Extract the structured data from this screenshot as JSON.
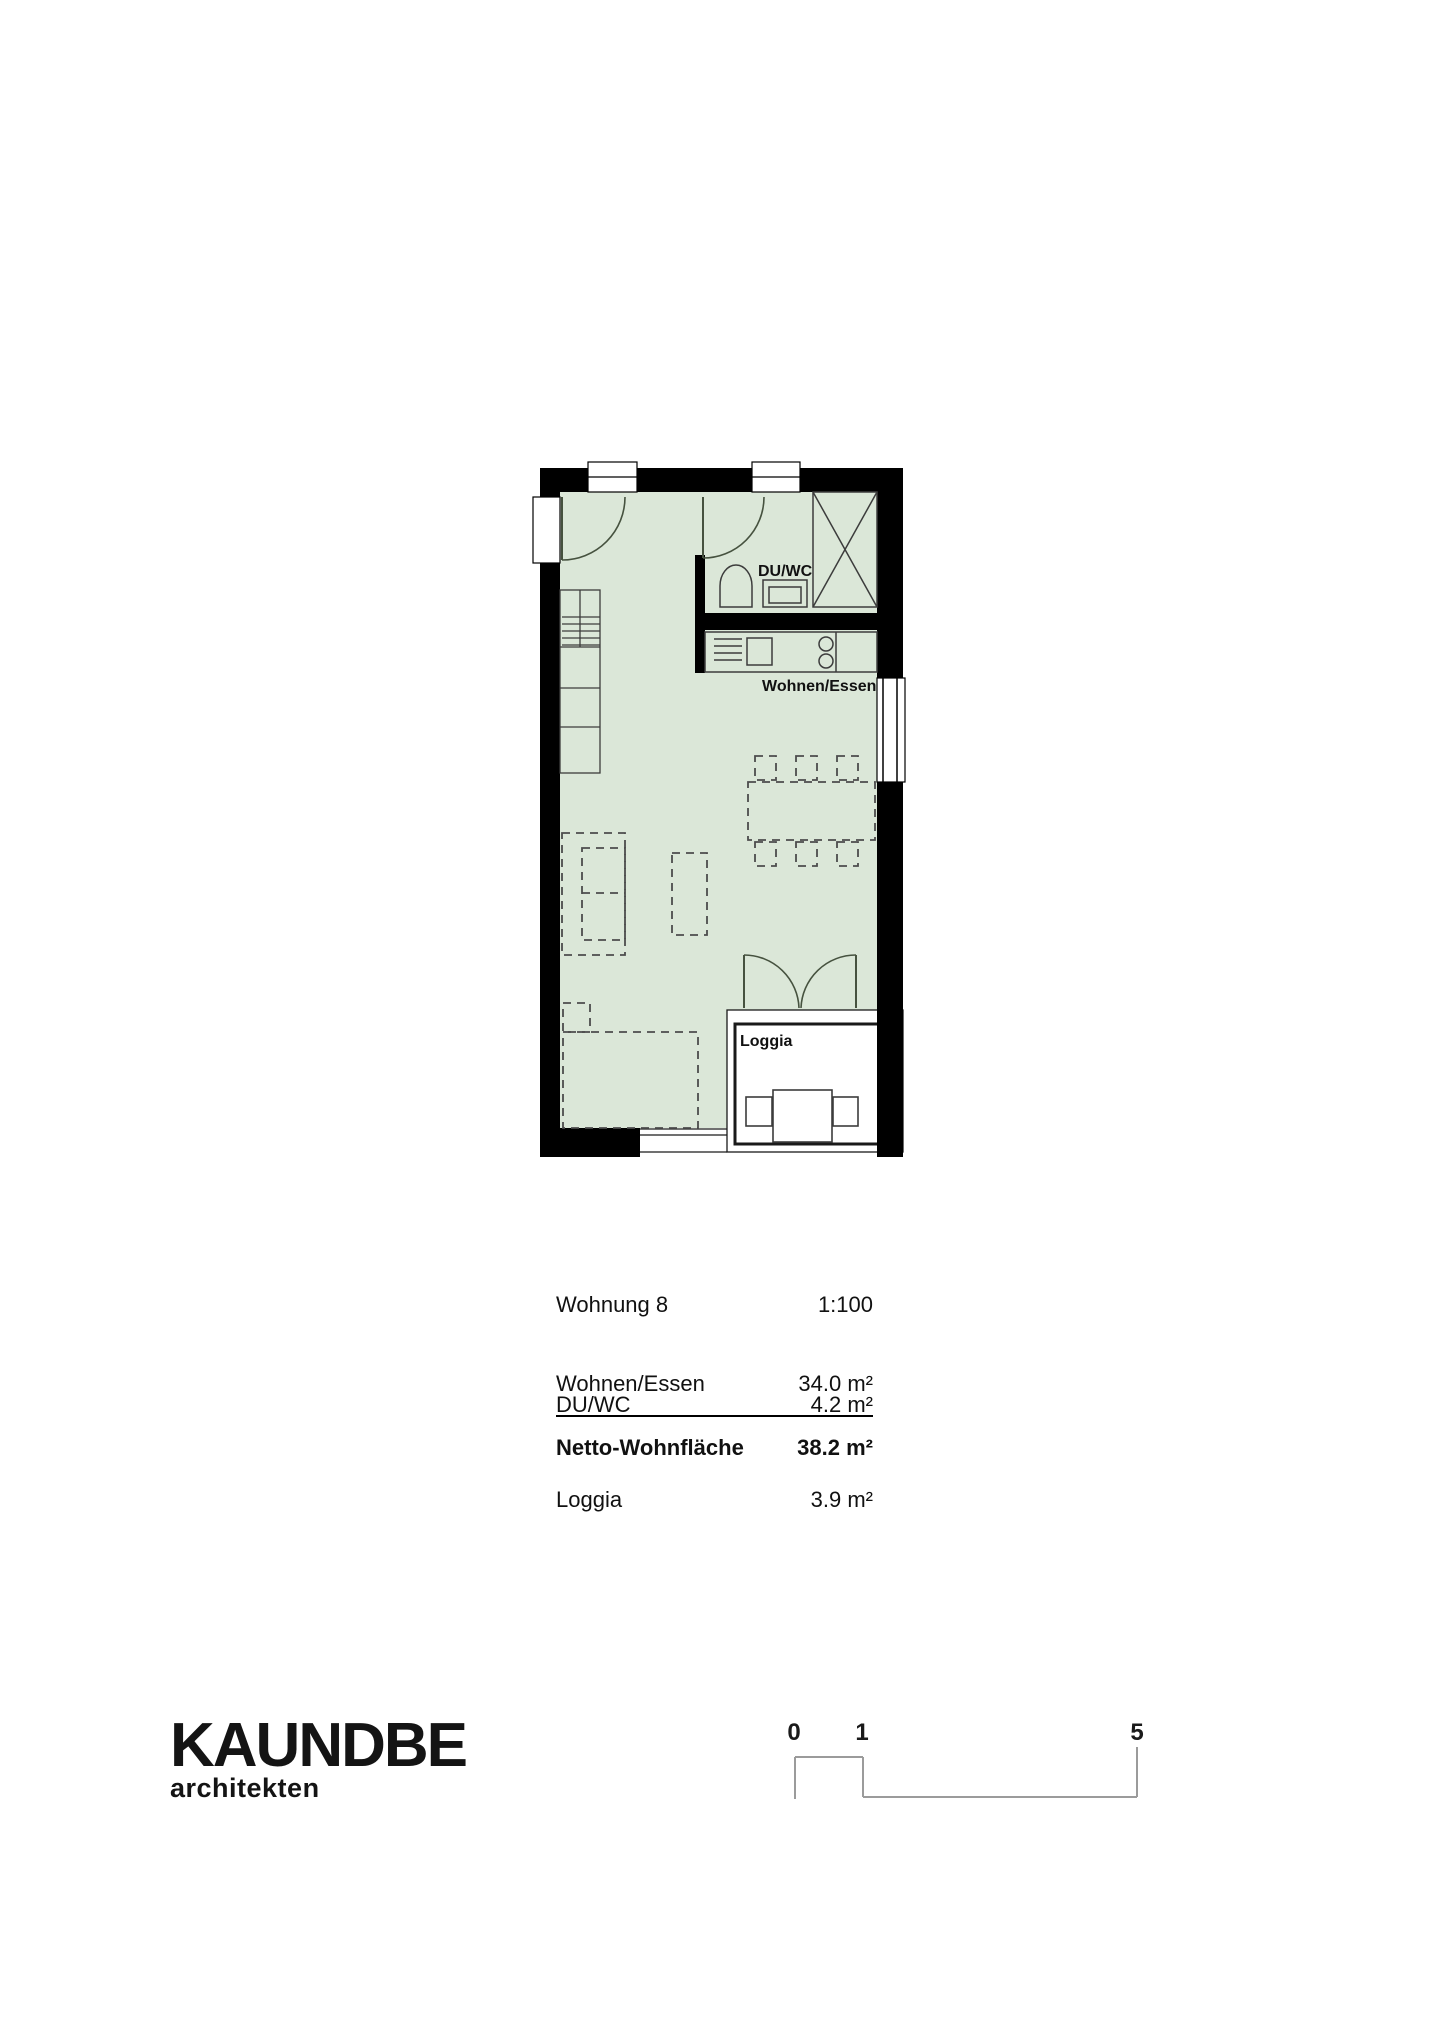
{
  "plan": {
    "room_labels": {
      "duwc": "DU/WC",
      "wohnen_essen": "Wohnen/Essen",
      "loggia": "Loggia"
    },
    "fill_color": "#dbe7d8",
    "wall_color": "#000000"
  },
  "info_table": {
    "title": "Wohnung 8",
    "scale": "1:100",
    "rows": [
      {
        "label": "Wohnen/Essen",
        "value": "34.0 m²"
      },
      {
        "label": "DU/WC",
        "value": "4.2 m²"
      }
    ],
    "total": {
      "label": "Netto-Wohnfläche",
      "value": "38.2 m²"
    },
    "extra": {
      "label": "Loggia",
      "value": "3.9 m²"
    }
  },
  "logo": {
    "name": "KAUNDBE",
    "subtitle": "architekten"
  },
  "scale_bar": {
    "labels": [
      "0",
      "1",
      "5"
    ]
  }
}
